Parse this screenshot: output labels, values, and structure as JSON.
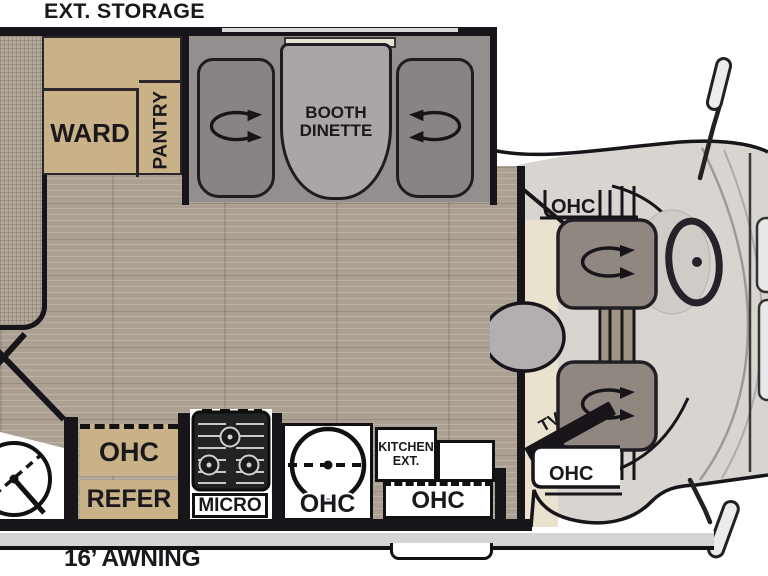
{
  "labels": {
    "ext_storage": "EXT. STORAGE",
    "ward": "WARD",
    "pantry": "PANTRY",
    "booth_dinette": "BOOTH DINETTE",
    "awning": "16’ AWNING"
  },
  "kitchen": {
    "ohc": "OHC",
    "refer": "REFER",
    "micro": "MICRO",
    "sink_ohc": "OHC",
    "kitchen_ext": "KITCHEN EXT.",
    "entry_ohc": "OHC"
  },
  "cab": {
    "ohc_top": "OHC",
    "tv": "TV",
    "ohc_door": "OHC"
  },
  "colors": {
    "wall": "#17141a",
    "wood_floor": "#aba092",
    "cabinet_tan": "#c9b287",
    "booth_wall": "#958e8f",
    "seat_gray": "#8a8384",
    "table_gray": "#aaa6a7",
    "cab_body": "#d8d5d1",
    "cab_floor_cream": "#e9e2cf",
    "cab_seat": "#8f8780",
    "awning_rail": "#d5d5d5"
  }
}
